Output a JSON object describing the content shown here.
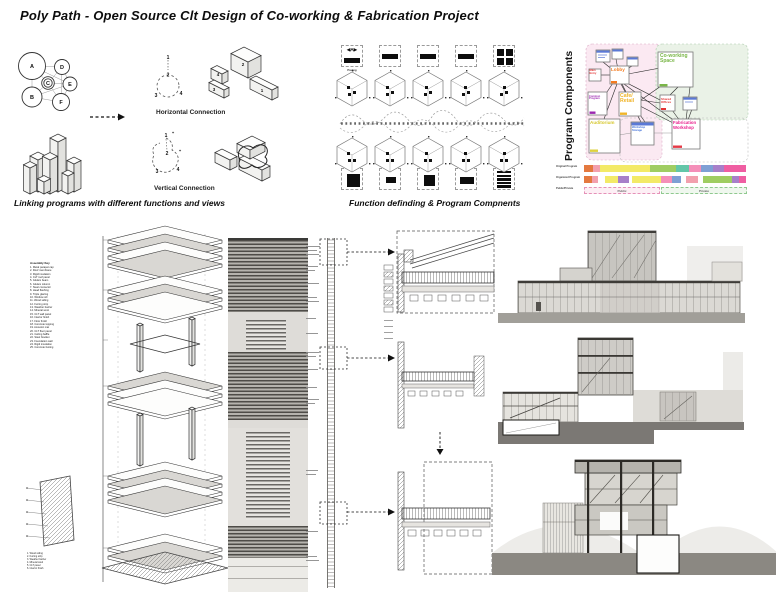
{
  "title": "Poly Path - Open Source Clt Design of Co-working & Fabrication Project",
  "linking_section": {
    "caption": "Linking programs with different functions and views",
    "bubble_labels": [
      "A",
      "B",
      "C",
      "D",
      "E",
      "F"
    ],
    "horizontal": {
      "label": "Horizontal Connection",
      "circle_nodes": [
        "1",
        "2",
        "3",
        "4"
      ],
      "box_numbers": [
        "2",
        "4",
        "3",
        "1"
      ]
    },
    "vertical": {
      "label": "Vertical Connection",
      "circle_nodes": [
        "1",
        "2",
        "3",
        "4"
      ],
      "plus_marks": [
        "+",
        "+"
      ]
    }
  },
  "function_section": {
    "caption": "Function definding & Program Compnents",
    "marker_a": "◀A▶",
    "marker_a_sublabel": "Paving"
  },
  "program_section": {
    "title": "Program Components",
    "nodes": {
      "main_entry": "Main Entry",
      "lobby": "Lobby",
      "coworking": "Co-working Space",
      "cafe": "Cafe/ Retail",
      "commons": "Common Program",
      "shared_offices": "Shared Offices",
      "auditorium": "Auditorium",
      "storage": "Workshop Storage",
      "fabrication": "Fabrication Workshop"
    },
    "node_colors": {
      "main_entry": "#e33535",
      "lobby": "#f47b20",
      "coworking": "#7ab648",
      "cafe": "#f0b429",
      "commons": "#9c27b0",
      "shared_offices": "#e33535",
      "auditorium": "#d6c72e",
      "storage": "#3f6fd8",
      "fabrication": "#e91e8c"
    },
    "bars": {
      "row1_label": "Original Program",
      "row2_label": "Organized Program",
      "row3_label": "Public/Private",
      "public_label": "Public",
      "private_label": "Private",
      "row1_segments": [
        {
          "c": "#e4793f",
          "w": 9
        },
        {
          "c": "#f2a0ae",
          "w": 7
        },
        {
          "c": "#f3ea67",
          "w": 50
        },
        {
          "c": "#9fcd62",
          "w": 26
        },
        {
          "c": "#63c6a8",
          "w": 13
        },
        {
          "c": "#f48fb9",
          "w": 12
        },
        {
          "c": "#7e9fd4",
          "w": 12
        },
        {
          "c": "#a77fc9",
          "w": 11
        },
        {
          "c": "#ef5ea2",
          "w": 22
        }
      ],
      "row2_segments": [
        {
          "c": "#e4793f",
          "w": 8
        },
        {
          "c": "#f2a0ae",
          "w": 6
        },
        {
          "gap": 7
        },
        {
          "c": "#f3ea67",
          "w": 13
        },
        {
          "c": "#a77fc9",
          "w": 11
        },
        {
          "gap": 3
        },
        {
          "c": "#f3ea67",
          "w": 29
        },
        {
          "c": "#f48fb9",
          "w": 11
        },
        {
          "c": "#7e9fd4",
          "w": 9
        },
        {
          "gap": 5
        },
        {
          "c": "#f2a0ae",
          "w": 12
        },
        {
          "gap": 5
        },
        {
          "c": "#9fcd62",
          "w": 29
        },
        {
          "c": "#a77fc9",
          "w": 7
        },
        {
          "c": "#ef5ea2",
          "w": 7
        }
      ]
    }
  },
  "detail_section": {
    "legend_title": "Assembly Key",
    "legend_items": [
      "1. Metal parapet cap",
      "2. Roof membrane",
      "3. Rigid insulation",
      "4. CLT roof panel",
      "5. Glulam beam",
      "6. Glulam column",
      "7. Steel connector",
      "8. Head flashing",
      "9. Triple glazing",
      "10. Window sill",
      "11. Wood siding",
      "12. Furring strip",
      "13. Weather barrier",
      "14. Mineral wool",
      "15. CLT wall panel",
      "16. Interior finish",
      "17. Floor finish",
      "18. Concrete topping",
      "19. Acoustic mat",
      "20. CLT floor panel",
      "21. Ceiling baffle",
      "22. Steel bracket",
      "23. Foundation wall",
      "24. Rigid insulation",
      "25. Concrete footing"
    ],
    "wall_key_items": [
      "1. Wood siding",
      "2. Furring strip",
      "3. Weather barrier",
      "4. Mineral wool",
      "5. CLT panel",
      "6. Interior finish"
    ]
  }
}
